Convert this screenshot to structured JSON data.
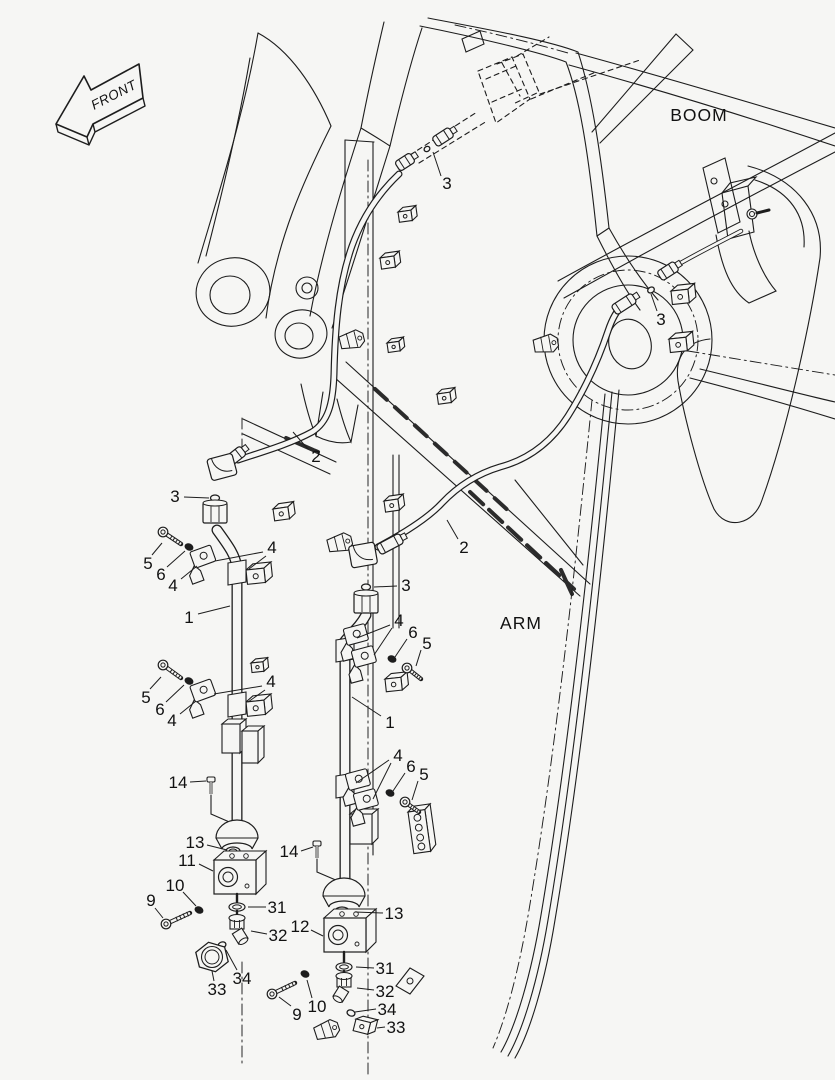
{
  "colors": {
    "background": "#f6f6f4",
    "line": "#1d1d1d",
    "label": "#111111"
  },
  "front_arrow": {
    "label": "FRONT"
  },
  "region_labels": [
    {
      "id": "boom-label",
      "text": "BOOM",
      "x": 699,
      "y": 121
    },
    {
      "id": "arm-label",
      "text": "ARM",
      "x": 521,
      "y": 629
    }
  ],
  "callouts": [
    {
      "text": "3",
      "x": 447,
      "y": 183,
      "leaders": [
        [
          441,
          176,
          433,
          152
        ]
      ]
    },
    {
      "text": "3",
      "x": 661,
      "y": 319,
      "leaders": [
        [
          657,
          311,
          651,
          294
        ]
      ]
    },
    {
      "text": "2",
      "x": 316,
      "y": 456,
      "leaders": [
        [
          308,
          449,
          293,
          432
        ]
      ]
    },
    {
      "text": "3",
      "x": 175,
      "y": 496,
      "leaders": [
        [
          184,
          497,
          209,
          498
        ]
      ]
    },
    {
      "text": "5",
      "x": 148,
      "y": 563,
      "leaders": [
        [
          152,
          555,
          162,
          543
        ]
      ]
    },
    {
      "text": "6",
      "x": 161,
      "y": 574,
      "leaders": [
        [
          167,
          567,
          185,
          551
        ]
      ]
    },
    {
      "text": "4",
      "x": 173,
      "y": 585,
      "leaders": [
        [
          181,
          579,
          197,
          566
        ]
      ]
    },
    {
      "text": "4",
      "x": 272,
      "y": 547,
      "leaders": [
        [
          263,
          552,
          215,
          561
        ],
        [
          266,
          556,
          249,
          569
        ]
      ]
    },
    {
      "text": "1",
      "x": 189,
      "y": 617,
      "leaders": [
        [
          198,
          614,
          230,
          606
        ]
      ]
    },
    {
      "text": "2",
      "x": 464,
      "y": 547,
      "leaders": [
        [
          458,
          539,
          447,
          520
        ]
      ]
    },
    {
      "text": "3",
      "x": 406,
      "y": 585,
      "leaders": [
        [
          397,
          586,
          374,
          587
        ]
      ]
    },
    {
      "text": "4",
      "x": 399,
      "y": 620,
      "leaders": [
        [
          390,
          625,
          357,
          638
        ],
        [
          392,
          628,
          374,
          655
        ]
      ]
    },
    {
      "text": "6",
      "x": 413,
      "y": 632,
      "leaders": [
        [
          407,
          639,
          395,
          657
        ]
      ]
    },
    {
      "text": "5",
      "x": 427,
      "y": 643,
      "leaders": [
        [
          421,
          650,
          416,
          666
        ]
      ]
    },
    {
      "text": "1",
      "x": 390,
      "y": 722,
      "leaders": [
        [
          381,
          716,
          352,
          697
        ]
      ]
    },
    {
      "text": "5",
      "x": 146,
      "y": 697,
      "leaders": [
        [
          150,
          689,
          161,
          677
        ]
      ]
    },
    {
      "text": "6",
      "x": 160,
      "y": 709,
      "leaders": [
        [
          166,
          702,
          184,
          685
        ]
      ]
    },
    {
      "text": "4",
      "x": 172,
      "y": 720,
      "leaders": [
        [
          180,
          714,
          196,
          701
        ]
      ]
    },
    {
      "text": "4",
      "x": 271,
      "y": 681,
      "leaders": [
        [
          262,
          686,
          214,
          694
        ],
        [
          265,
          690,
          248,
          702
        ]
      ]
    },
    {
      "text": "4",
      "x": 398,
      "y": 755,
      "leaders": [
        [
          389,
          760,
          356,
          783
        ],
        [
          391,
          763,
          373,
          799
        ]
      ]
    },
    {
      "text": "6",
      "x": 411,
      "y": 766,
      "leaders": [
        [
          405,
          773,
          393,
          791
        ]
      ]
    },
    {
      "text": "5",
      "x": 424,
      "y": 774,
      "leaders": [
        [
          418,
          781,
          412,
          800
        ]
      ]
    },
    {
      "text": "14",
      "x": 178,
      "y": 782,
      "leaders": [
        [
          190,
          782,
          206,
          781
        ]
      ]
    },
    {
      "text": "13",
      "x": 195,
      "y": 842,
      "leaders": [
        [
          207,
          845,
          227,
          850
        ]
      ]
    },
    {
      "text": "11",
      "x": 187,
      "y": 860,
      "leaders": [
        [
          199,
          864,
          213,
          871
        ]
      ]
    },
    {
      "text": "10",
      "x": 175,
      "y": 885,
      "leaders": [
        [
          183,
          892,
          196,
          906
        ]
      ]
    },
    {
      "text": "9",
      "x": 151,
      "y": 900,
      "leaders": [
        [
          155,
          908,
          163,
          918
        ]
      ]
    },
    {
      "text": "31",
      "x": 277,
      "y": 907,
      "leaders": [
        [
          266,
          907,
          248,
          907
        ]
      ]
    },
    {
      "text": "32",
      "x": 278,
      "y": 935,
      "leaders": [
        [
          267,
          934,
          251,
          931
        ]
      ]
    },
    {
      "text": "34",
      "x": 242,
      "y": 978,
      "leaders": [
        [
          237,
          970,
          226,
          950
        ]
      ]
    },
    {
      "text": "33",
      "x": 217,
      "y": 989,
      "leaders": [
        [
          214,
          981,
          212,
          971
        ]
      ]
    },
    {
      "text": "14",
      "x": 289,
      "y": 851,
      "leaders": [
        [
          301,
          851,
          313,
          847
        ]
      ]
    },
    {
      "text": "13",
      "x": 394,
      "y": 913,
      "leaders": [
        [
          383,
          913,
          355,
          912
        ]
      ]
    },
    {
      "text": "12",
      "x": 300,
      "y": 926,
      "leaders": [
        [
          311,
          930,
          323,
          936
        ]
      ]
    },
    {
      "text": "31",
      "x": 385,
      "y": 968,
      "leaders": [
        [
          374,
          968,
          356,
          967
        ]
      ]
    },
    {
      "text": "32",
      "x": 385,
      "y": 991,
      "leaders": [
        [
          374,
          990,
          357,
          988
        ]
      ]
    },
    {
      "text": "34",
      "x": 387,
      "y": 1009,
      "leaders": [
        [
          376,
          1009,
          355,
          1012
        ]
      ]
    },
    {
      "text": "33",
      "x": 396,
      "y": 1027,
      "leaders": [
        [
          385,
          1027,
          377,
          1028
        ]
      ]
    },
    {
      "text": "10",
      "x": 317,
      "y": 1006,
      "leaders": [
        [
          312,
          998,
          307,
          980
        ]
      ]
    },
    {
      "text": "9",
      "x": 297,
      "y": 1014,
      "leaders": [
        [
          291,
          1006,
          279,
          997
        ]
      ]
    }
  ]
}
